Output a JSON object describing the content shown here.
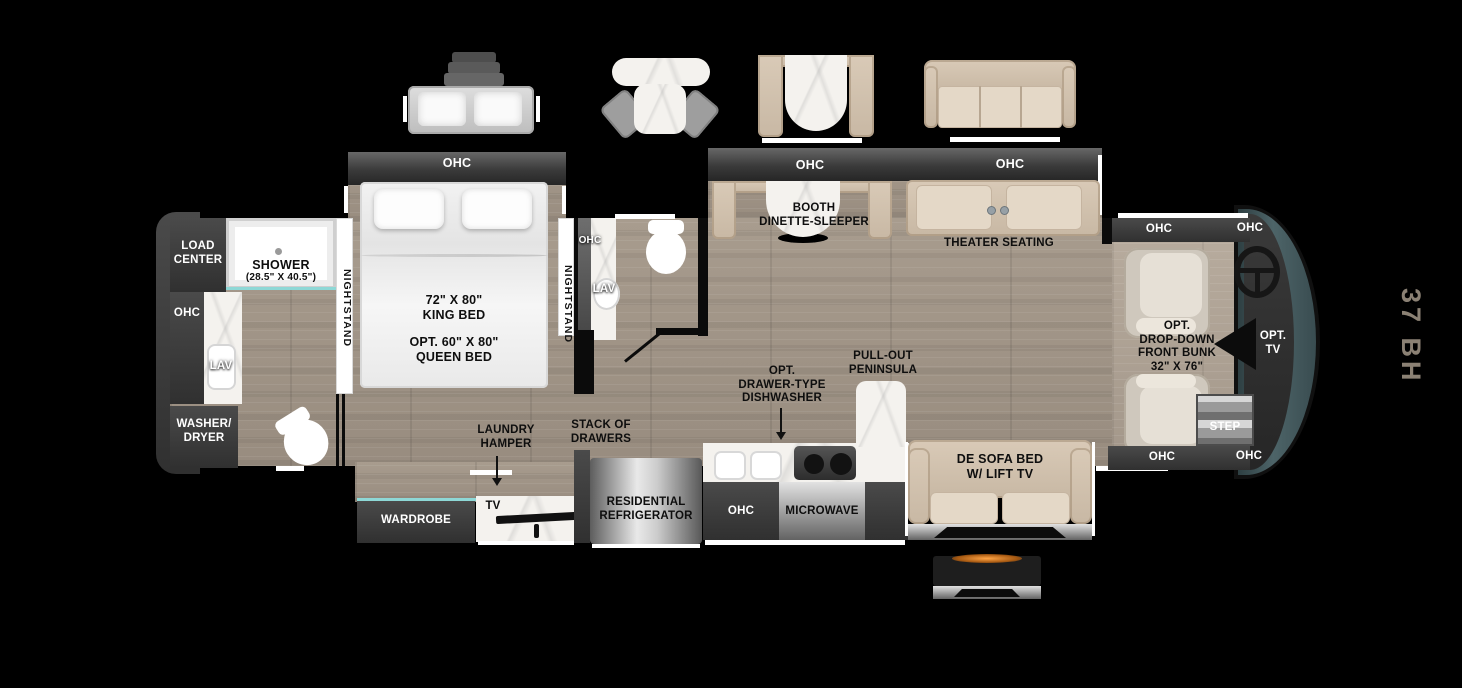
{
  "model_badge": "37 BH",
  "labels": {
    "load_center": "LOAD\nCENTER",
    "shower": "SHOWER",
    "shower_size": "(28.5\" X 40.5\")",
    "rear_ohc": "OHC",
    "rear_lav": "LAV",
    "washer_dryer": "WASHER/\nDRYER",
    "nightstand_left": "NIGHTSTAND",
    "nightstand_right": "NIGHTSTAND",
    "bed_ohc": "OHC",
    "bed_size": "72\" X 80\"\nKING BED",
    "bed_opt": "OPT. 60\" X 80\"\nQUEEN BED",
    "half_bath_ohc": "OHC",
    "half_bath_lav": "LAV",
    "wardrobe": "WARDROBE",
    "tv": "TV",
    "laundry_hamper": "LAUNDRY\nHAMPER",
    "stack_of_drawers": "STACK OF\nDRAWERS",
    "refrigerator": "RESIDENTIAL\nREFRIGERATOR",
    "kitchen_ohc": "OHC",
    "microwave": "MICROWAVE",
    "dishwasher": "OPT.\nDRAWER-TYPE\nDISHWASHER",
    "peninsula": "PULL-OUT\nPENINSULA",
    "living_ohc_left": "OHC",
    "living_ohc_right": "OHC",
    "booth": "BOOTH\nDINETTE-SLEEPER",
    "theater": "THEATER SEATING",
    "sofa": "DE SOFA BED\nW/ LIFT TV",
    "front_ohc_top_left": "OHC",
    "front_ohc_top_right": "OHC",
    "front_ohc_bottom_left": "OHC",
    "front_ohc_bottom_right": "OHC",
    "front_bunk": "OPT.\nDROP-DOWN\nFRONT BUNK\n32\" X 76\"",
    "opt_tv": "OPT.\nTV",
    "step": "STEP"
  },
  "colors": {
    "background": "#000000",
    "floor_wood": "#a3978a",
    "cabinet_dark": "#3a3a3a",
    "furniture_tan": "#d3c4b1",
    "marble": "#f4f2ee",
    "appliance_silver": "#bdbdbd",
    "accent_teal": "#8ed8d6",
    "front_cap": "#43575b",
    "model_text": "#8b8174"
  }
}
